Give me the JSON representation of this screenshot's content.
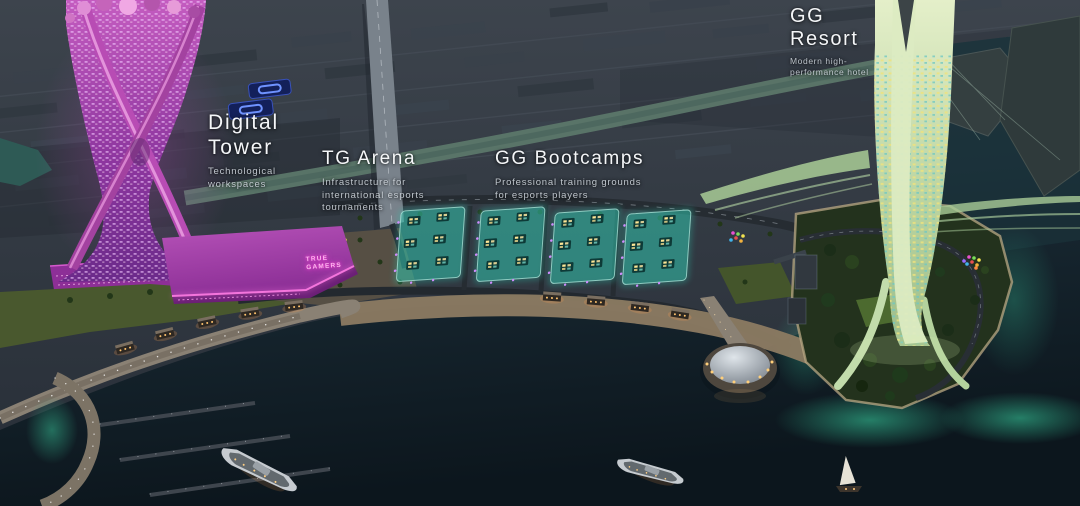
{
  "labels": {
    "digital_tower": {
      "title_line1": "Digital",
      "title_line2": "Tower",
      "subtitle_line1": "Technological",
      "subtitle_line2": "workspaces"
    },
    "tg_arena": {
      "title": "TG Arena",
      "subtitle_line1": "Infrastructure for",
      "subtitle_line2": "international esports",
      "subtitle_line3": "tournaments"
    },
    "gg_bootcamps": {
      "title": "GG Bootcamps",
      "subtitle_line1": "Professional training grounds",
      "subtitle_line2": "for esports players"
    },
    "gg_resort": {
      "title_line1": "GG",
      "title_line2": "Resort",
      "subtitle_line1": "Modern high-",
      "subtitle_line2": "performance hotel"
    }
  },
  "signs": {
    "arena_side_line1": "TRUE",
    "arena_side_line2": "GAMERS"
  },
  "palette": {
    "label_text": "#f4f6f8",
    "label_subtext": "#d5dce3",
    "tower_magenta": "#b84cb4",
    "arena_pink_glow": "#ff7ce4",
    "bootcamp_teal": "#35c9b4",
    "resort_green": "#cfe3b8",
    "island_glow_green": "#2fae8c",
    "bay_water": "#22333f",
    "deep_water": "#0e1a21",
    "city_dark": "#2b323b",
    "billboard_blue": "#3b55c4"
  }
}
